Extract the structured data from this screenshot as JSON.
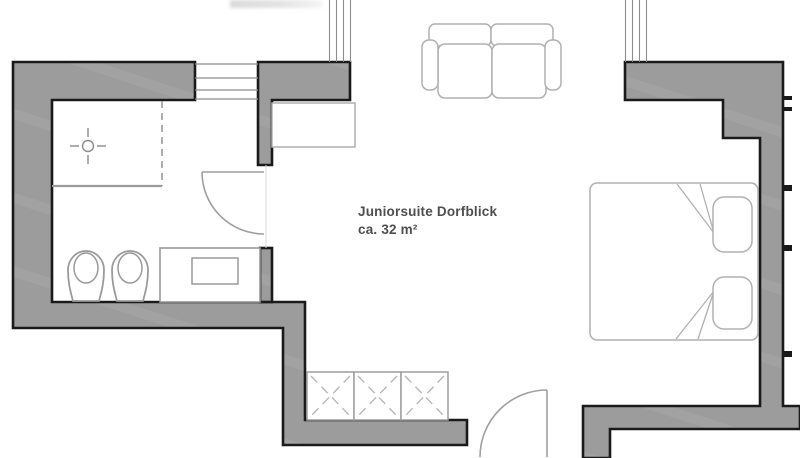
{
  "plan": {
    "room_label_line1": "Juniorsuite Dorfblick",
    "room_label_line2": "ca. 32 m²"
  },
  "colors": {
    "bg": "#ffffff",
    "wall_fill": "#9c9c9c",
    "wall_streak": "#a9a9a9",
    "wall_stroke": "#1a1a1a",
    "furniture_stroke": "#b0b0b0",
    "fixture_stroke": "#9a9a9a",
    "door_stroke": "#9f9f9f",
    "window_stroke": "#8c8c8c",
    "text": "#4e4e4e"
  },
  "plan_items": {
    "bathroom": [
      "shower-area",
      "floor-drain",
      "toilet",
      "bidet",
      "washbasin-vanity",
      "bathroom-door"
    ],
    "main_room": [
      "double-bed",
      "pillows",
      "sofa",
      "wardrobe",
      "closet-units",
      "entrance-door"
    ],
    "openings": [
      "top-window",
      "balcony-railing-left",
      "balcony-railing-right",
      "right-wall-window-ticks"
    ]
  }
}
